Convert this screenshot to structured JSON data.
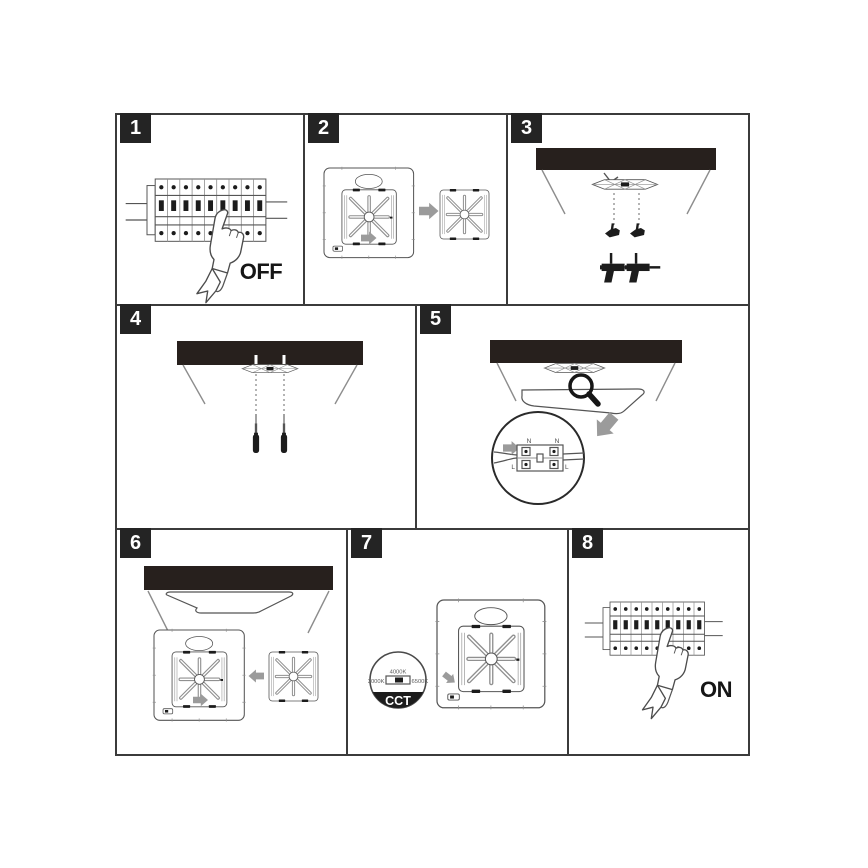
{
  "colors": {
    "ink": "#1c1c1c",
    "line": "#555555",
    "lattice": "#909090",
    "ceiling": "#27201d",
    "arrow": "#9b9b9b",
    "badge_bg": "#242424",
    "badge_text": "#ffffff",
    "background": "#ffffff",
    "panel_border": "#3b3b3b"
  },
  "steps": [
    {
      "number": "1",
      "state_label": "OFF"
    },
    {
      "number": "2"
    },
    {
      "number": "3"
    },
    {
      "number": "4"
    },
    {
      "number": "5",
      "terminal": {
        "n_left": "N",
        "n_right": "N",
        "l_left": "L",
        "l_right": "L"
      }
    },
    {
      "number": "6"
    },
    {
      "number": "7",
      "cct": {
        "top_option": "4000K",
        "left_option": "3000K",
        "right_option": "6500K",
        "label": "CCT"
      }
    },
    {
      "number": "8",
      "state_label": "ON"
    }
  ]
}
